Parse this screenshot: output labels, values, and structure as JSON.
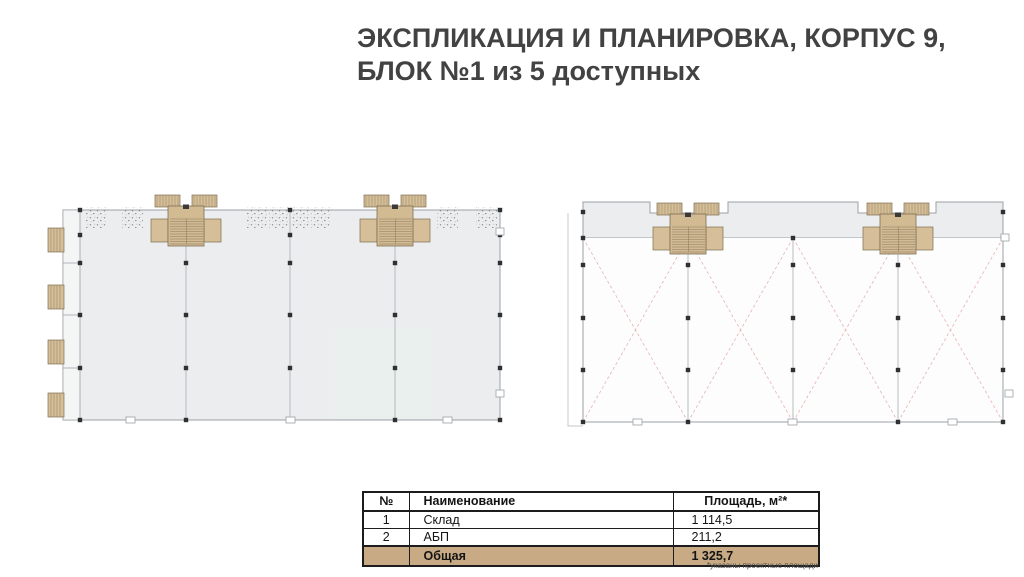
{
  "page": {
    "title_line1": "ЭКСПЛИКАЦИЯ И ПЛАНИРОВКА, КОРПУС 9,",
    "title_line2": "БЛОК №1 из 5 доступных",
    "footnote": "*указаны проектные площади"
  },
  "table": {
    "headers": {
      "num": "№",
      "name": "Наименование",
      "area": "Площадь, м²*"
    },
    "rows": [
      {
        "num": "1",
        "name": "Склад",
        "area": "1 114,5"
      },
      {
        "num": "2",
        "name": "АБП",
        "area": "211,2"
      }
    ],
    "total": {
      "label": "Общая",
      "area": "1 325,7"
    }
  },
  "colors": {
    "accent_tan": "#c8ab84",
    "stair_tan": "#d4bd96",
    "plan_fill": "#ecedee",
    "brace_pink": "#eab9b9",
    "column_dark": "#2e3032",
    "outline_gray": "#9ba1a6",
    "title_gray": "#424242"
  }
}
